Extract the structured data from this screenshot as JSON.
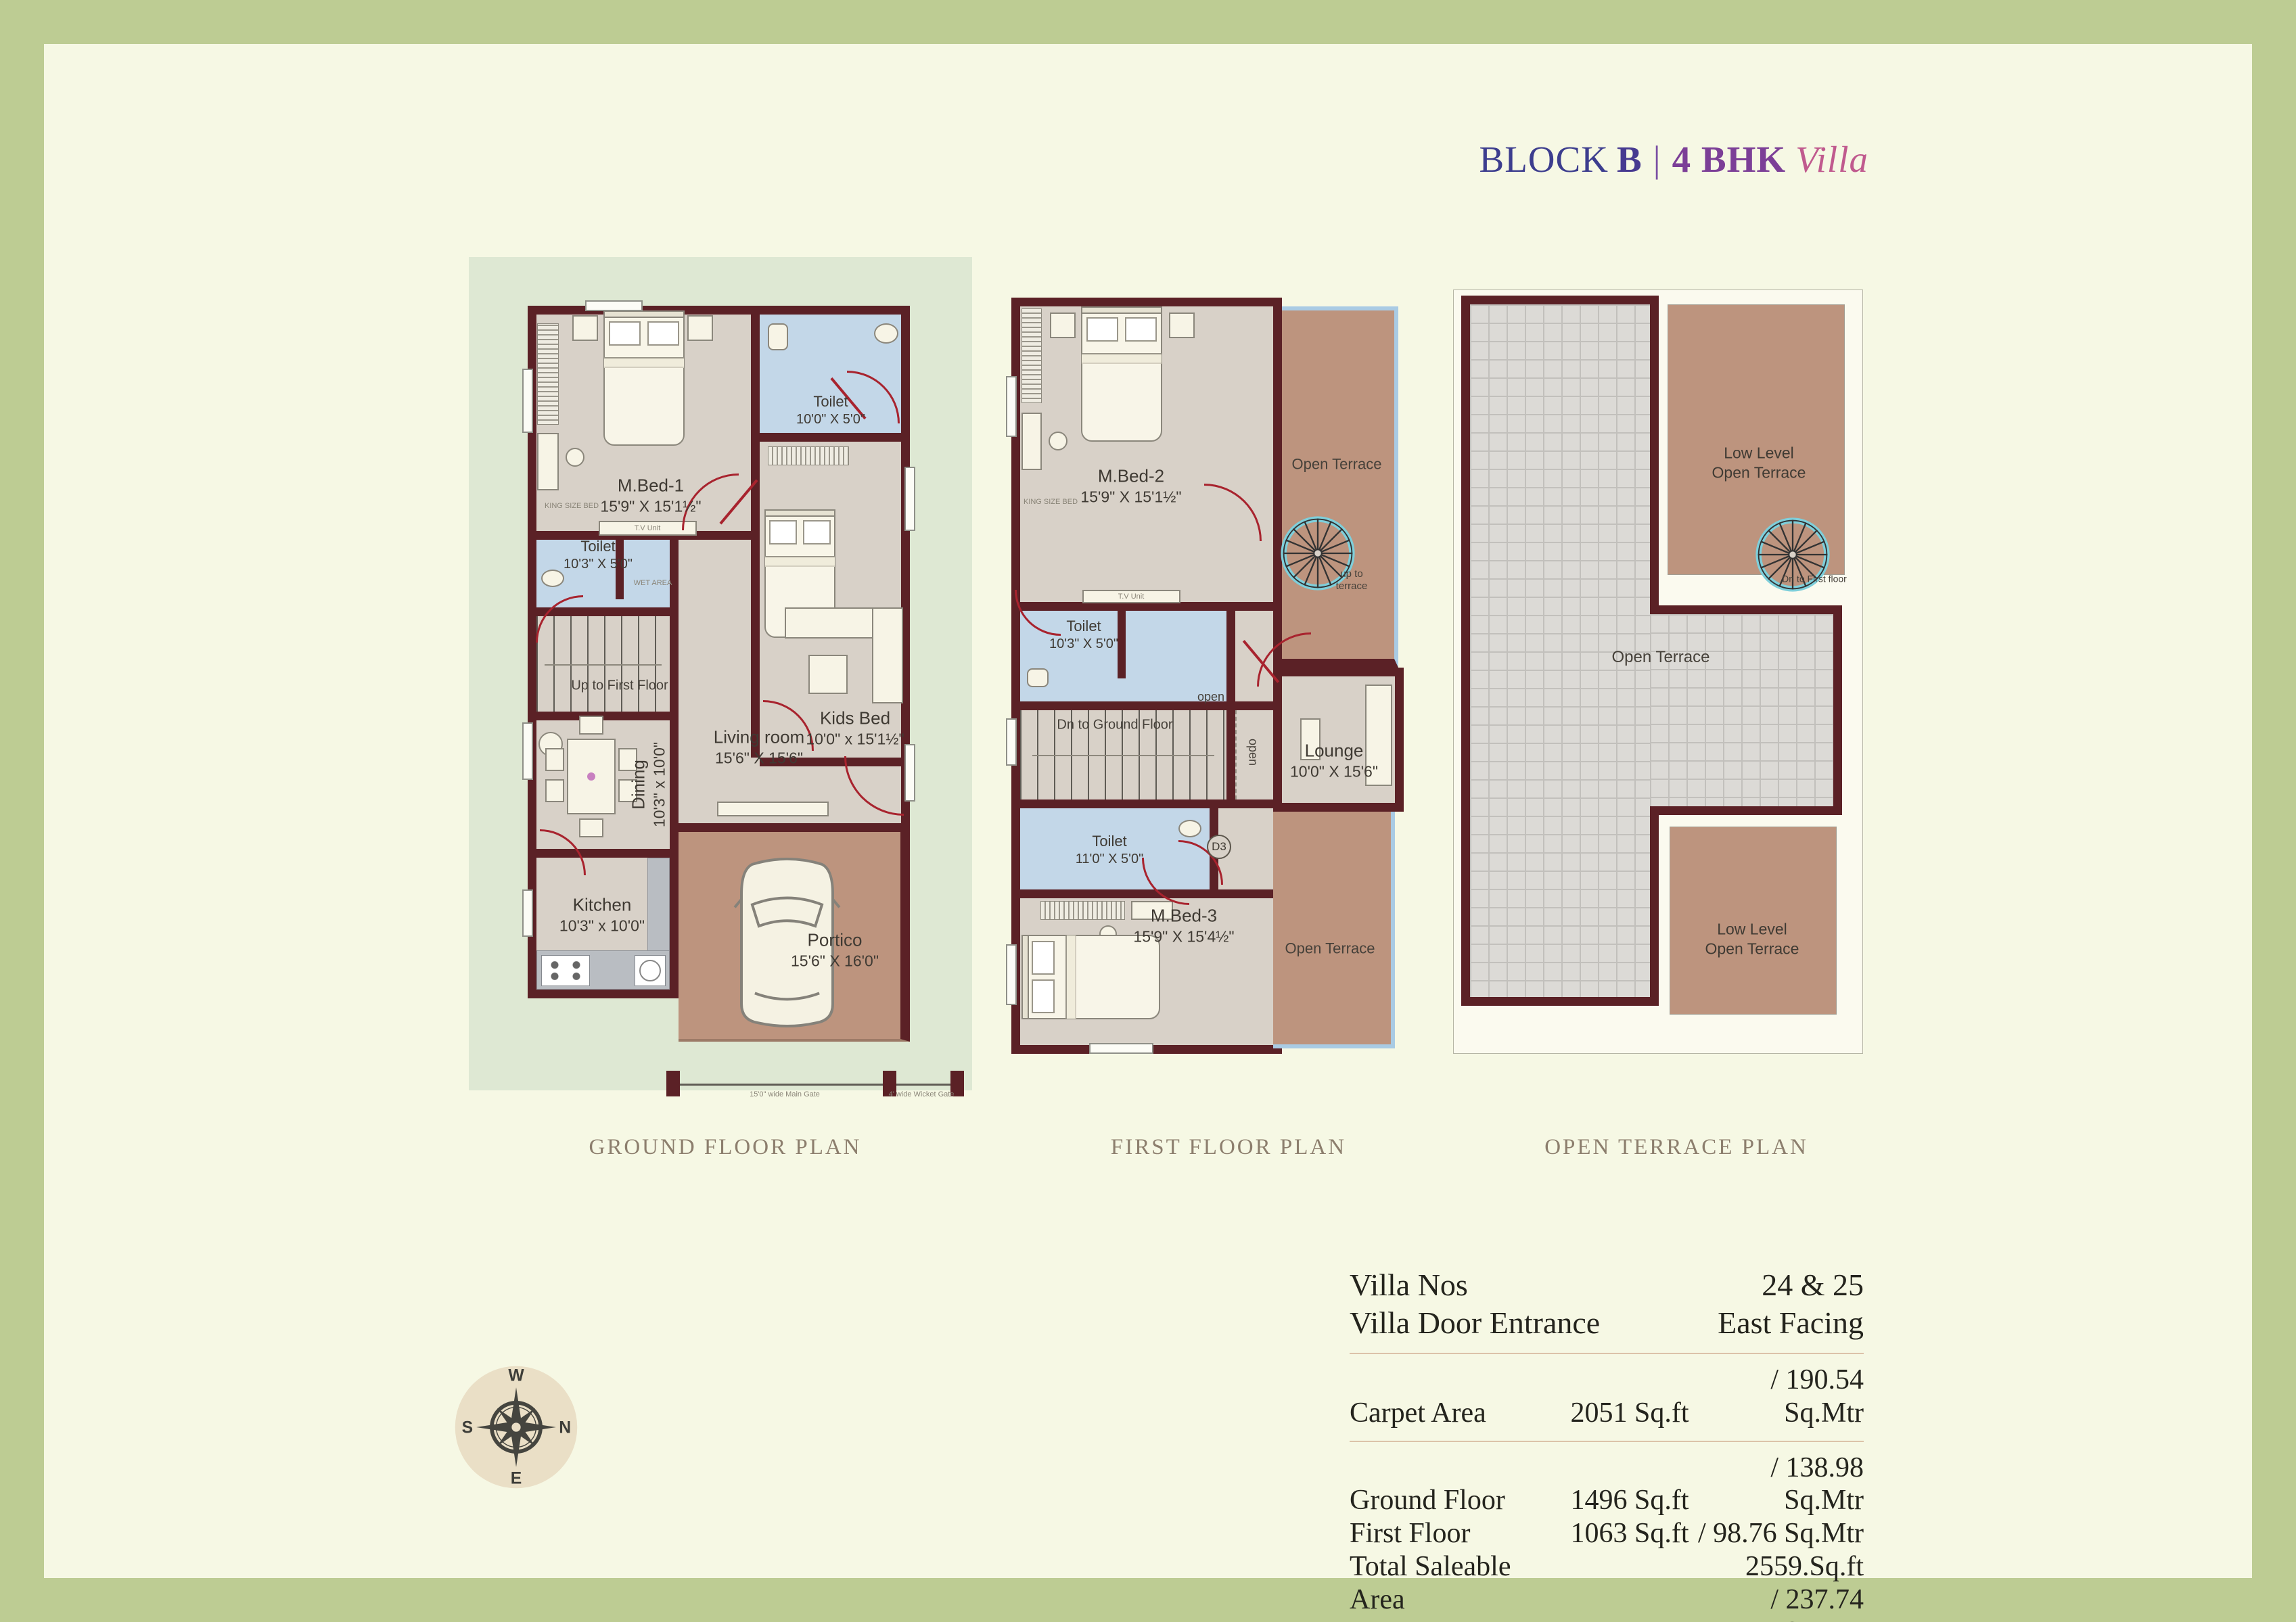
{
  "title": {
    "block": "BLOCK",
    "letter": "B",
    "sep": "|",
    "bhk": "4 BHK",
    "villa": "Villa"
  },
  "plans": {
    "ground": {
      "caption": "GROUND FLOOR PLAN",
      "rooms": {
        "mbed1": {
          "name": "M.Bed-1",
          "dims": "15'9\" X 15'1½\""
        },
        "toilet_top": {
          "name": "Toilet",
          "dims": "10'0\" X 5'0\""
        },
        "kids": {
          "name": "Kids Bed",
          "dims": "10'0\" x 15'1½\""
        },
        "toilet_mid": {
          "name": "Toilet",
          "dims": "10'3\" X 5'0\""
        },
        "stairs": {
          "label": "Up to First Floor"
        },
        "dining": {
          "name": "Dining",
          "dims": "10'3\" x 10'0\""
        },
        "living": {
          "name": "Living room",
          "dims": "15'6\" X 15'6\""
        },
        "kitchen": {
          "name": "Kitchen",
          "dims": "10'3\" x 10'0\""
        },
        "portico": {
          "name": "Portico",
          "dims": "15'6\" X 16'0\""
        }
      },
      "gates": {
        "main": "15'0\" wide Main Gate",
        "wicket": "4' wide Wicket Gate"
      }
    },
    "first": {
      "caption": "FIRST FLOOR PLAN",
      "rooms": {
        "mbed2": {
          "name": "M.Bed-2",
          "dims": "15'9\" X 15'1½\""
        },
        "toilet1": {
          "name": "Toilet",
          "dims": "10'3\" X 5'0\""
        },
        "stairs": {
          "label": "Dn to Ground Floor"
        },
        "toilet2": {
          "name": "Toilet",
          "dims": "11'0\" X 5'0\""
        },
        "mbed3": {
          "name": "M.Bed-3",
          "dims": "15'9\" X 15'4½\""
        },
        "lounge": {
          "name": "Lounge",
          "dims": "10'0\" X 15'6\""
        }
      },
      "terrace_label": "Open Terrace",
      "up_stair": "up to terrace",
      "open": "open",
      "door_tag": "D3"
    },
    "terrace": {
      "caption": "OPEN TERRACE PLAN",
      "main": "Open Terrace",
      "low_level_line1": "Low Level",
      "low_level_line2": "Open Terrace",
      "dn_stair": "Dn to First floor"
    }
  },
  "micro": {
    "king": "KING SIZE BED",
    "tv": "T.V Unit",
    "wardrobe": "WARDROBE",
    "wet": "WET AREA"
  },
  "compass": {
    "n": "N",
    "e": "E",
    "s": "S",
    "w": "W"
  },
  "details": {
    "rows": [
      {
        "label": "Villa Nos",
        "value": "24 & 25"
      },
      {
        "label": "Villa Door Entrance",
        "value": "East Facing"
      }
    ],
    "carpet": {
      "label": "Carpet Area",
      "sqft": "2051 Sq.ft",
      "sqmtr": "/ 190.54 Sq.Mtr"
    },
    "areas": [
      {
        "label": "Ground Floor",
        "sqft": "1496 Sq.ft",
        "sqmtr": "/ 138.98 Sq.Mtr"
      },
      {
        "label": "First Floor",
        "sqft": "1063 Sq.ft",
        "sqmtr": "/  98.76 Sq.Mtr"
      },
      {
        "label": "Total Saleable Area",
        "sqft": "2559.Sq.ft",
        "sqmtr": "/ 237.74 Sq.Mtr"
      }
    ]
  },
  "colors": {
    "page_border": "#bdcc93",
    "page_bg": "#f6f8e4",
    "panel_green": "#dee8d3",
    "wall_maroon": "#5b2126",
    "floor_taupe": "#d8d1c8",
    "toilet_blue": "#c3d7e8",
    "terrace_brown": "#bd947e",
    "tile_gray": "#dcdad6",
    "door_red": "#a8232e",
    "stair_rim_cyan": "#7ecfdb",
    "terrace_edge_blue": "#a9cbe4",
    "title_blue": "#3c3d8e",
    "title_purple": "#7c3f97",
    "title_pink": "#c05a8e",
    "caption_brown": "#8c7e6d"
  }
}
